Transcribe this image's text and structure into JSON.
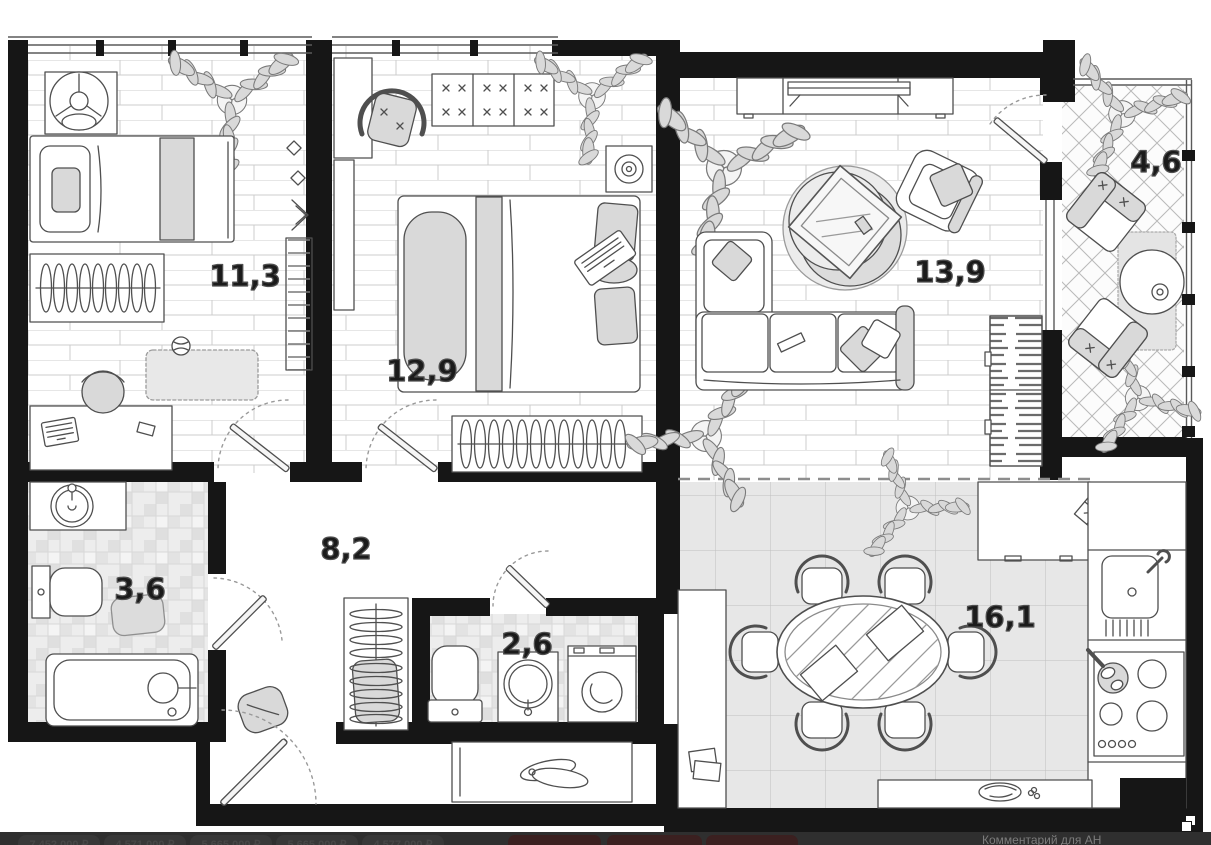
{
  "plan": {
    "rooms": {
      "bedroom_1": {
        "area": "11,3"
      },
      "bedroom_2": {
        "area": "12,9"
      },
      "living_room": {
        "area": "13,9"
      },
      "balcony": {
        "area": "4,6"
      },
      "bathroom": {
        "area": "3,6"
      },
      "hallway": {
        "area": "8,2"
      },
      "wc": {
        "area": "2,6"
      },
      "kitchen_living": {
        "area": "16,1"
      }
    }
  },
  "bottom_bar": {
    "prices": [
      "7 452 000 ₽",
      "4 571 000 ₽",
      "5 665 000 ₽",
      "5 665 000 ₽",
      "4 577 000 ₽"
    ],
    "comment_label": "Комментарий для АН"
  },
  "icons": {
    "bottom_right": "copy-icon"
  },
  "colors": {
    "wall": "#161616",
    "bar_background": "#2f2f2f",
    "chip_maroon": "#3b2020",
    "price_text": "#474747",
    "comment_text": "#7c7c7c",
    "area_label": "#1b1b1b"
  }
}
